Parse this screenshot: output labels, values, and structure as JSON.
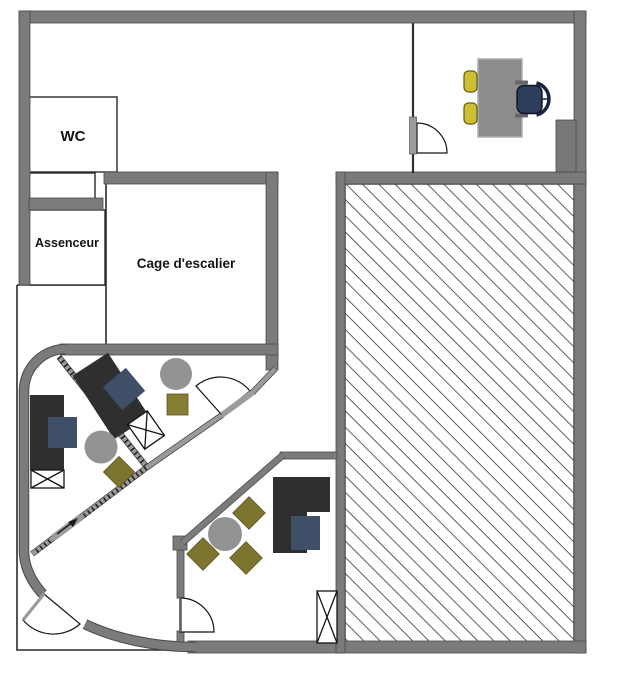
{
  "type": "floor-plan",
  "rooms": [
    {
      "id": "wc",
      "label": "WC"
    },
    {
      "id": "elevator",
      "label": "Assenceur"
    },
    {
      "id": "stairwell",
      "label": "Cage d'escalier"
    }
  ],
  "zones": [
    {
      "id": "hatched-zone",
      "style": "diagonal-hatch"
    }
  ],
  "furniture": {
    "dark_desks": 3,
    "blue_desk_chairs": 3,
    "round_tables": 3,
    "olive_side_chairs": 5,
    "yellow_visitor_chairs": 2,
    "executive_chair": 1,
    "crossed_storage_boxes": 3,
    "cabinet": 1,
    "doors": 4
  },
  "icons": {
    "direction_arrow": "up-right"
  },
  "palette": {
    "wall": "#7b7b7b",
    "wall_outline": "#4a4a4a",
    "desk_dark": "#2f2f2f",
    "chair_blue": "#3e4f67",
    "chair_olive": "#7c742f",
    "chair_yellow": "#cdbf33",
    "table_gray": "#939393",
    "desk_gray": "#8c8c8c",
    "executive_chair_navy": "#2e3d59",
    "hatch_line": "#2b2b2b",
    "background": "#ffffff"
  }
}
